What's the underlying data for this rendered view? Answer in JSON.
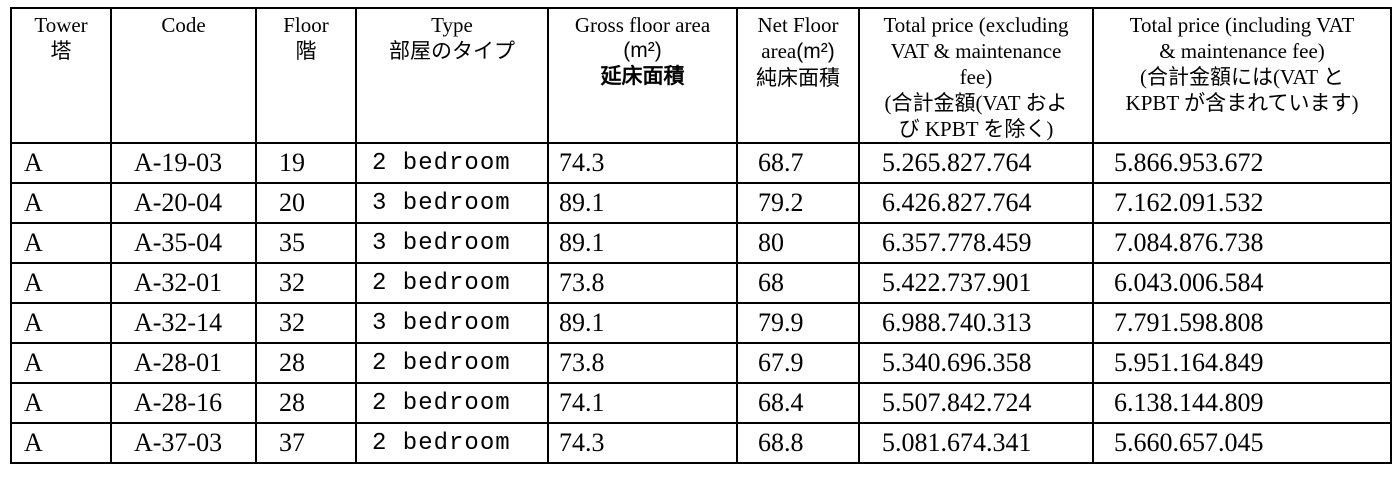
{
  "header": {
    "tower": {
      "en": "Tower",
      "ja": "塔"
    },
    "code": {
      "en": "Code"
    },
    "floor": {
      "en": "Floor",
      "ja": "階"
    },
    "type": {
      "en": "Type",
      "ja": "部屋のタイプ"
    },
    "gross_area": {
      "en": "Gross floor area",
      "m2": "(m²)",
      "ja": "延床面積"
    },
    "net_area": {
      "en": "Net Floor",
      "en2": "area",
      "m2": "(m²)",
      "ja": "純床面積"
    },
    "price_excl": {
      "en1": "Total price (excluding",
      "en2": "VAT & maintenance",
      "en3": "fee)",
      "ja1": "(合計金額(VAT およ",
      "ja2": "び KPBT を除く)"
    },
    "price_incl": {
      "en1": "Total price (including VAT",
      "en2": "& maintenance fee)",
      "ja1": "(合計金額には(VAT と",
      "ja2": "KPBT が含まれています)"
    }
  },
  "col_ids": [
    "tower",
    "code",
    "floor",
    "type",
    "gross-area",
    "net-area",
    "price-excl",
    "price-incl"
  ],
  "rows": [
    [
      "A",
      "A-19-03",
      "19",
      "2 bedroom",
      "74.3",
      "68.7",
      "5.265.827.764",
      "5.866.953.672"
    ],
    [
      "A",
      "A-20-04",
      "20",
      "3 bedroom",
      "89.1",
      "79.2",
      "6.426.827.764",
      "7.162.091.532"
    ],
    [
      "A",
      "A-35-04",
      "35",
      "3 bedroom",
      "89.1",
      "80",
      "6.357.778.459",
      "7.084.876.738"
    ],
    [
      "A",
      "A-32-01",
      "32",
      "2 bedroom",
      "73.8",
      "68",
      "5.422.737.901",
      "6.043.006.584"
    ],
    [
      "A",
      "A-32-14",
      "32",
      "3 bedroom",
      "89.1",
      "79.9",
      "6.988.740.313",
      "7.791.598.808"
    ],
    [
      "A",
      "A-28-01",
      "28",
      "2 bedroom",
      "73.8",
      "67.9",
      "5.340.696.358",
      "5.951.164.849"
    ],
    [
      "A",
      "A-28-16",
      "28",
      "2 bedroom",
      "74.1",
      "68.4",
      "5.507.842.724",
      "6.138.144.809"
    ],
    [
      "A",
      "A-37-03",
      "37",
      "2 bedroom",
      "74.3",
      "68.8",
      "5.081.674.341",
      "5.660.657.045"
    ]
  ]
}
